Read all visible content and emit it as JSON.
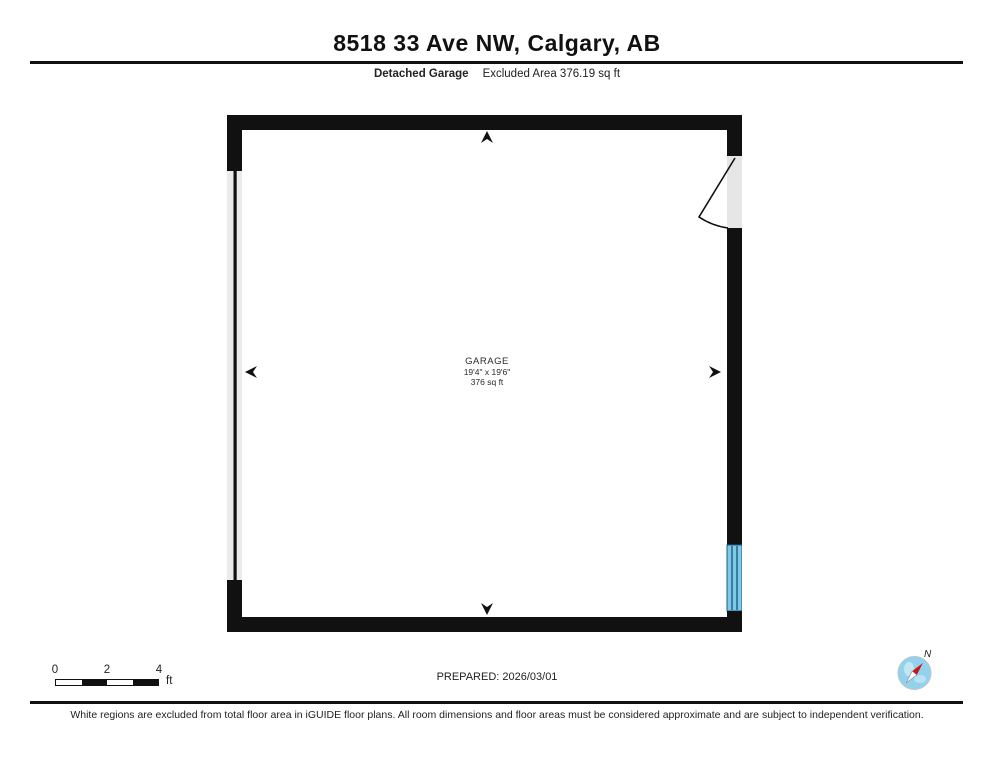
{
  "header": {
    "title": "8518 33 Ave NW, Calgary, AB",
    "floor_label": "Detached Garage",
    "excluded_area": "Excluded Area 376.19 sq ft"
  },
  "floorplan": {
    "room": {
      "name": "GARAGE",
      "dimensions": "19'4\" x 19'6\"",
      "area": "376 sq ft"
    },
    "colors": {
      "wall": "#111111",
      "opening_gray": "#e6e6e6",
      "window_fill": "#7ec9e8",
      "window_line": "#1b5e83",
      "compass_globe": "#93d2ed",
      "compass_needle_red": "#cc1414"
    }
  },
  "footer": {
    "scale": {
      "tick0": "0",
      "tick2": "2",
      "tick4": "4",
      "unit": "ft"
    },
    "prepared": "PREPARED: 2026/03/01",
    "compass_label": "N",
    "disclaimer": "White regions are excluded from total floor area in iGUIDE floor plans. All room dimensions and floor areas must be considered approximate and are subject to independent verification."
  }
}
